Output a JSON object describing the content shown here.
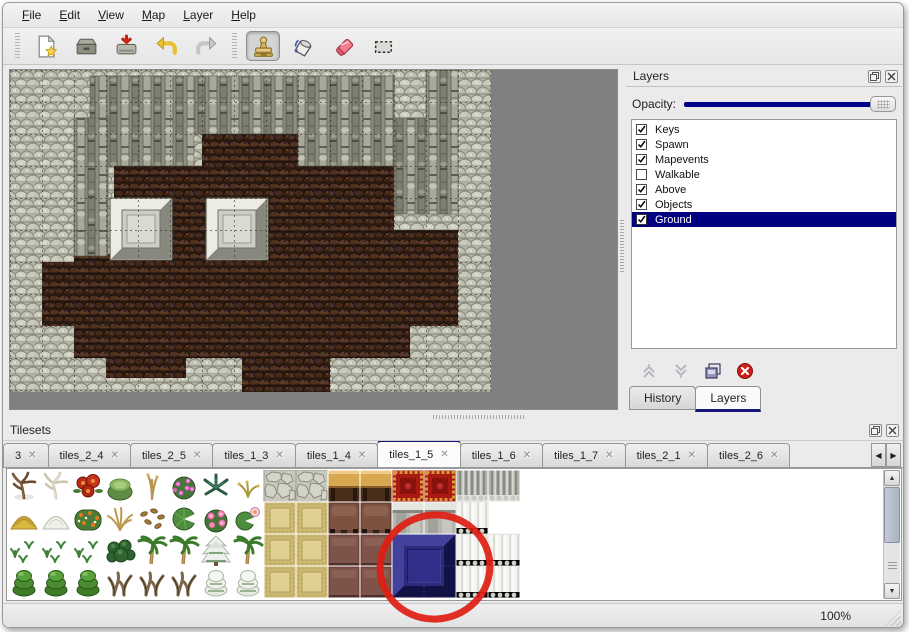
{
  "menu": {
    "items": [
      {
        "label": "File"
      },
      {
        "label": "Edit"
      },
      {
        "label": "View"
      },
      {
        "label": "Map"
      },
      {
        "label": "Layer"
      },
      {
        "label": "Help"
      }
    ]
  },
  "toolbar": {
    "buttons": [
      {
        "name": "new-file",
        "active": false
      },
      {
        "name": "open-file",
        "active": false
      },
      {
        "name": "save-file",
        "active": false
      },
      {
        "name": "undo",
        "active": false
      },
      {
        "name": "redo",
        "active": false
      },
      {
        "name": "stamp-tool",
        "active": true
      },
      {
        "name": "fill-tool",
        "active": false
      },
      {
        "name": "eraser-tool",
        "active": false
      },
      {
        "name": "rect-select-tool",
        "active": false
      }
    ]
  },
  "layers_panel": {
    "title": "Layers",
    "opacity_label": "Opacity:",
    "opacity_percent": 100,
    "layers": [
      {
        "name": "Keys",
        "checked": true,
        "selected": false
      },
      {
        "name": "Spawn",
        "checked": true,
        "selected": false
      },
      {
        "name": "Mapevents",
        "checked": true,
        "selected": false
      },
      {
        "name": "Walkable",
        "checked": false,
        "selected": false
      },
      {
        "name": "Above",
        "checked": true,
        "selected": false
      },
      {
        "name": "Objects",
        "checked": true,
        "selected": false
      },
      {
        "name": "Ground",
        "checked": true,
        "selected": true
      }
    ],
    "actions": [
      {
        "name": "move-layer-up",
        "enabled": false
      },
      {
        "name": "move-layer-down",
        "enabled": false
      },
      {
        "name": "duplicate-layer",
        "enabled": true
      },
      {
        "name": "delete-layer",
        "enabled": true
      }
    ],
    "tabs": [
      {
        "label": "History",
        "active": false
      },
      {
        "label": "Layers",
        "active": true
      }
    ]
  },
  "tilesets_panel": {
    "title": "Tilesets",
    "tabs": [
      {
        "label": "3",
        "active": false
      },
      {
        "label": "tiles_2_4",
        "active": false
      },
      {
        "label": "tiles_2_5",
        "active": false
      },
      {
        "label": "tiles_1_3",
        "active": false
      },
      {
        "label": "tiles_1_4",
        "active": false
      },
      {
        "label": "tiles_1_5",
        "active": true
      },
      {
        "label": "tiles_1_6",
        "active": false
      },
      {
        "label": "tiles_1_7",
        "active": false
      },
      {
        "label": "tiles_2_1",
        "active": false
      },
      {
        "label": "tiles_2_6",
        "active": false
      }
    ],
    "tiles_grid": [
      [
        "dead-tree",
        "white-tree",
        "red-flower",
        "green-stump",
        "tan-sapling",
        "pink-flower-bush",
        "dark-fern",
        "yellow-sprig",
        "cobble",
        "cobble",
        "table-tan",
        "table-tan",
        "red-carpet",
        "red-carpet",
        "gray-curtain",
        "gray-curtain"
      ],
      [
        "hay-mound",
        "snow-mound",
        "flower-patch",
        "dry-grass",
        "leaf-scatter",
        "lily-pad",
        "rose-bush",
        "lily-pad-flower",
        "tan-floor",
        "tan-floor",
        "brown-cushion",
        "brown-cushion",
        "gray-mantle",
        "gray-mantle",
        "white-curtain",
        "blank"
      ],
      [
        "sprouts",
        "sprouts",
        "sprouts",
        "dark-bush",
        "palm-tree",
        "palm-tree",
        "snow-pine",
        "palm-tree",
        "tan-floor",
        "tan-floor",
        "brown-tile",
        "brown-tile",
        "blue-tile",
        "skip",
        "white-curtain",
        "white-curtain"
      ],
      [
        "conifer",
        "conifer",
        "conifer",
        "twisted-tree",
        "twisted-tree",
        "twisted-tree",
        "snow-conifer",
        "snow-conifer",
        "tan-floor",
        "tan-floor",
        "brown-tile",
        "brown-tile",
        "skip",
        "skip",
        "white-curtain",
        "white-curtain"
      ]
    ]
  },
  "annotation": {
    "shape": "red-ellipse"
  },
  "status_bar": {
    "zoom_level": "100%"
  },
  "colors": {
    "selection_navy": "#000080",
    "opacity_slider": "#00008c",
    "annotation_red": "#df1d12",
    "active_tab_line": "#15157a",
    "canvas_gray": "#808080"
  }
}
